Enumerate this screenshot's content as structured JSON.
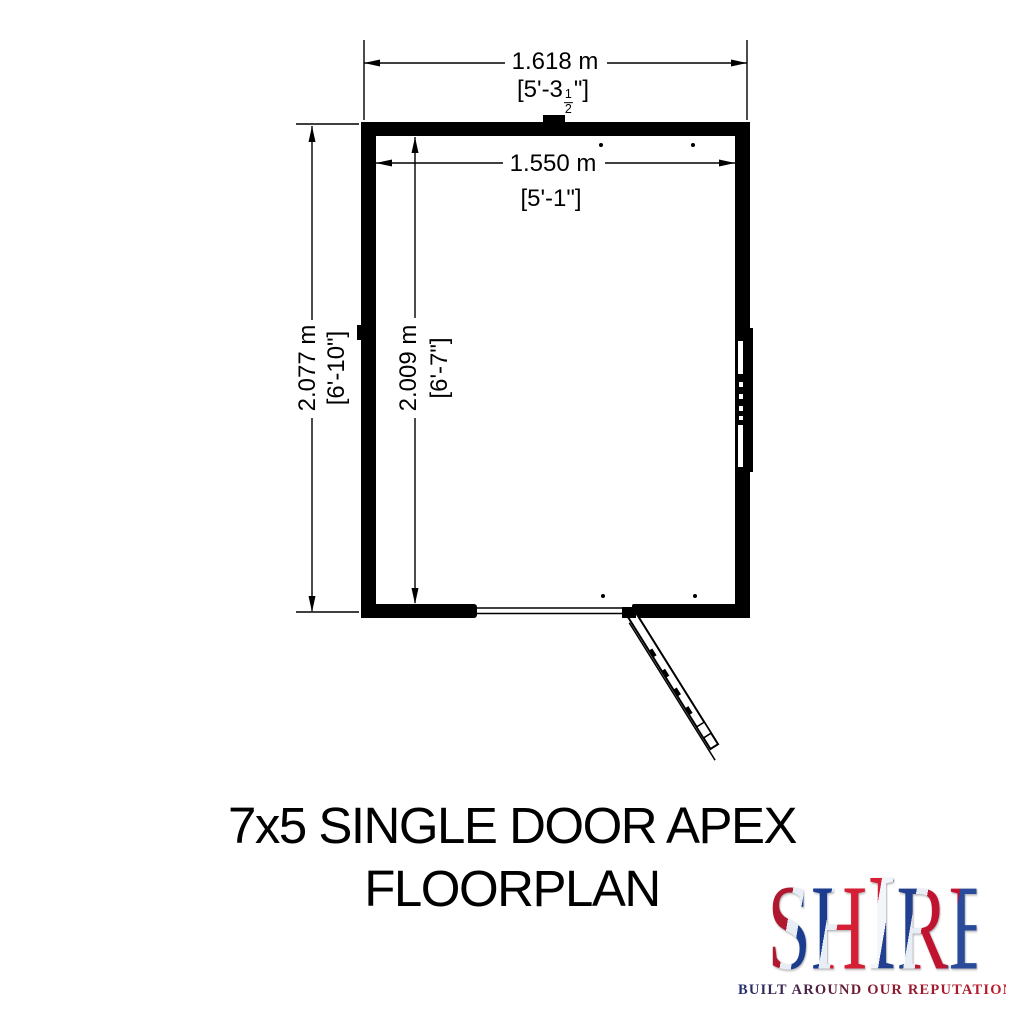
{
  "page": {
    "background": "#ffffff",
    "ink": "#000000"
  },
  "floorplan": {
    "dim_top_outer": {
      "metric": "1.618 m",
      "imperial_prefix": "[5'-3",
      "frac_num": "1",
      "frac_den": "2",
      "imperial_suffix": "\"]"
    },
    "dim_top_inner": {
      "metric": "1.550 m",
      "imperial": "[5'-1\"]"
    },
    "dim_side_outer": {
      "metric": "2.077 m",
      "imperial": "[6'-10\"]"
    },
    "dim_side_inner": {
      "metric": "2.009 m",
      "imperial": "[6'-7\"]"
    },
    "features": {
      "door": "single door, bottom wall, opens outward to lower right",
      "window": "window on right wall",
      "apex_marker": "ridge tab at centre of top wall"
    }
  },
  "title": {
    "line1": "7x5 SINGLE DOOR APEX",
    "line2": "FLOORPLAN"
  },
  "logo": {
    "part_sh": "SH",
    "part_i": "I",
    "part_re": "RE",
    "tagline": "BUILT AROUND OUR REPUTATION",
    "flag_red": "#c8102e",
    "flag_blue": "#012169"
  }
}
